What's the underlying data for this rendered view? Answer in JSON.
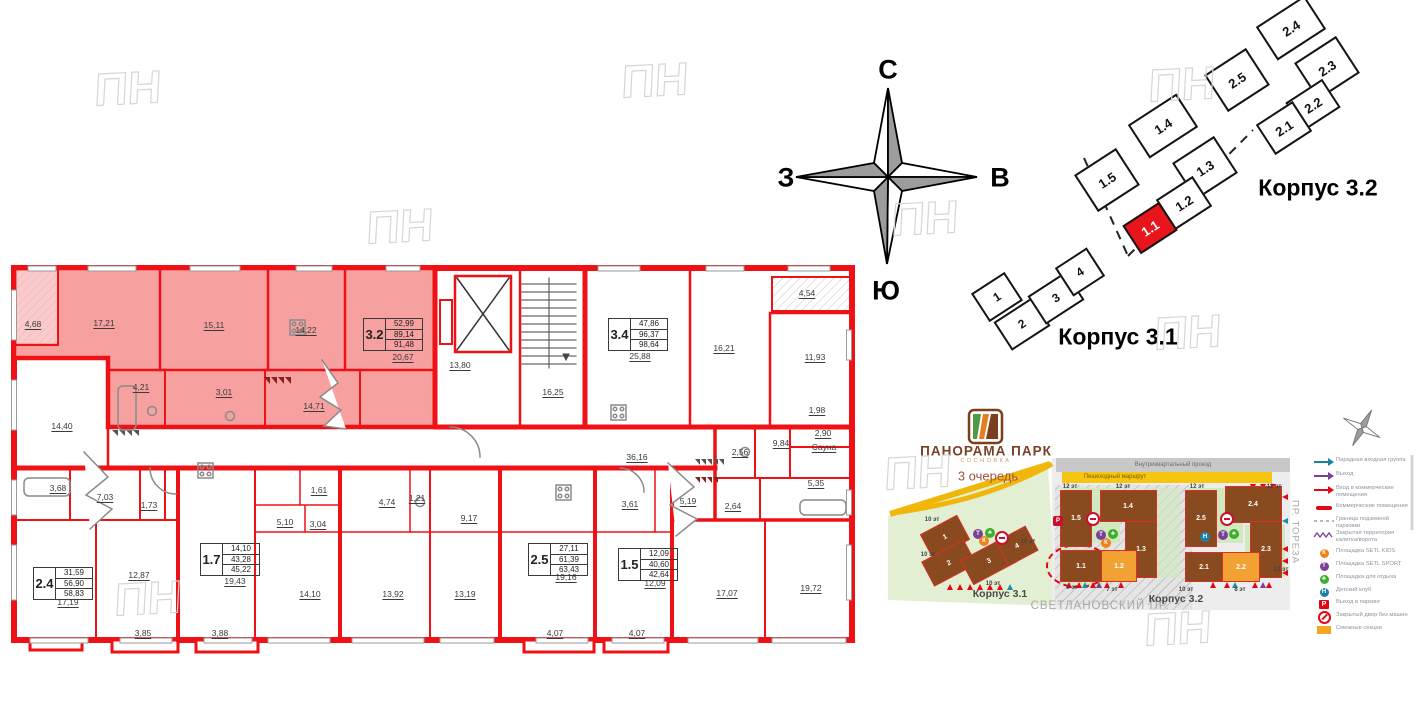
{
  "floor_plan": {
    "wall_color": "#ee1116",
    "highlight_color": "#f7a0a0",
    "room_labels": [
      {
        "t": "4,68",
        "x": 33,
        "y": 324
      },
      {
        "t": "17,21",
        "x": 104,
        "y": 323
      },
      {
        "t": "15,11",
        "x": 214,
        "y": 325
      },
      {
        "t": "14,22",
        "x": 306,
        "y": 330
      },
      {
        "t": "20,67",
        "x": 403,
        "y": 357
      },
      {
        "t": "4,21",
        "x": 141,
        "y": 387
      },
      {
        "t": "3,01",
        "x": 224,
        "y": 392
      },
      {
        "t": "14,71",
        "x": 314,
        "y": 406
      },
      {
        "t": "14,40",
        "x": 62,
        "y": 426
      },
      {
        "t": "13,80",
        "x": 460,
        "y": 365
      },
      {
        "t": "16,25",
        "x": 553,
        "y": 392
      },
      {
        "t": "25,88",
        "x": 640,
        "y": 356
      },
      {
        "t": "16,21",
        "x": 724,
        "y": 348
      },
      {
        "t": "11,93",
        "x": 815,
        "y": 357
      },
      {
        "t": "4,54",
        "x": 807,
        "y": 293
      },
      {
        "t": "1,98",
        "x": 817,
        "y": 410
      },
      {
        "t": "2,90",
        "x": 823,
        "y": 433
      },
      {
        "t": "Сауна",
        "x": 824,
        "y": 447
      },
      {
        "t": "9,84",
        "x": 781,
        "y": 443
      },
      {
        "t": "2,56",
        "x": 740,
        "y": 452
      },
      {
        "t": "36,16",
        "x": 637,
        "y": 457
      },
      {
        "t": "3,68",
        "x": 58,
        "y": 488
      },
      {
        "t": "7,03",
        "x": 105,
        "y": 497
      },
      {
        "t": "1,73",
        "x": 149,
        "y": 505
      },
      {
        "t": "17,19",
        "x": 68,
        "y": 602
      },
      {
        "t": "12,87",
        "x": 139,
        "y": 575
      },
      {
        "t": "3,85",
        "x": 143,
        "y": 633
      },
      {
        "t": "3,88",
        "x": 220,
        "y": 633
      },
      {
        "t": "19,43",
        "x": 235,
        "y": 581
      },
      {
        "t": "14,10",
        "x": 310,
        "y": 594
      },
      {
        "t": "5,10",
        "x": 285,
        "y": 522
      },
      {
        "t": "3,04",
        "x": 318,
        "y": 524
      },
      {
        "t": "1,61",
        "x": 319,
        "y": 490
      },
      {
        "t": "4,74",
        "x": 387,
        "y": 502
      },
      {
        "t": "1,21",
        "x": 417,
        "y": 498
      },
      {
        "t": "9,17",
        "x": 469,
        "y": 518
      },
      {
        "t": "13,92",
        "x": 393,
        "y": 594
      },
      {
        "t": "13,19",
        "x": 465,
        "y": 594
      },
      {
        "t": "19,16",
        "x": 566,
        "y": 577
      },
      {
        "t": "4,07",
        "x": 555,
        "y": 633
      },
      {
        "t": "3,61",
        "x": 630,
        "y": 504
      },
      {
        "t": "12,09",
        "x": 655,
        "y": 583
      },
      {
        "t": "4,07",
        "x": 637,
        "y": 633
      },
      {
        "t": "5,19",
        "x": 688,
        "y": 501
      },
      {
        "t": "2,64",
        "x": 733,
        "y": 506
      },
      {
        "t": "5,35",
        "x": 816,
        "y": 483
      },
      {
        "t": "17,07",
        "x": 727,
        "y": 593
      },
      {
        "t": "19,72",
        "x": 811,
        "y": 588
      }
    ],
    "apartments": [
      {
        "id": "3.2",
        "values": [
          "52,99",
          "89,14",
          "91,48"
        ],
        "x": 363,
        "y": 318,
        "hl": true
      },
      {
        "id": "3.4",
        "values": [
          "47,86",
          "96,37",
          "98,64"
        ],
        "x": 608,
        "y": 318,
        "hl": false
      },
      {
        "id": "2.4",
        "values": [
          "31,59",
          "56,90",
          "58,83"
        ],
        "x": 33,
        "y": 567,
        "hl": false
      },
      {
        "id": "1.7",
        "values": [
          "14,10",
          "43,28",
          "45,22"
        ],
        "x": 200,
        "y": 543,
        "hl": false
      },
      {
        "id": "2.5",
        "values": [
          "27,11",
          "61,39",
          "63,43"
        ],
        "x": 528,
        "y": 543,
        "hl": false
      },
      {
        "id": "1.5",
        "values": [
          "12,09",
          "40,60",
          "42,64"
        ],
        "x": 618,
        "y": 548,
        "hl": false
      }
    ]
  },
  "compass": {
    "n": "С",
    "s": "Ю",
    "w": "З",
    "e": "В"
  },
  "building_scheme": {
    "korpus_32_label": "Корпус 3.2",
    "korpus_31_label": "Корпус 3.1",
    "selected_unit": "1.1",
    "units": [
      {
        "id": "1.5",
        "x": 1107,
        "y": 180,
        "w": 46,
        "h": 40,
        "sel": false
      },
      {
        "id": "1.4",
        "x": 1163,
        "y": 126,
        "w": 54,
        "h": 36,
        "sel": false
      },
      {
        "id": "1.3",
        "x": 1205,
        "y": 168,
        "w": 46,
        "h": 40,
        "sel": false
      },
      {
        "id": "1.2",
        "x": 1184,
        "y": 203,
        "w": 40,
        "h": 32,
        "sel": false
      },
      {
        "id": "1.1",
        "x": 1150,
        "y": 228,
        "w": 40,
        "h": 30,
        "sel": true
      },
      {
        "id": "2.5",
        "x": 1237,
        "y": 80,
        "w": 46,
        "h": 40,
        "sel": false
      },
      {
        "id": "2.4",
        "x": 1291,
        "y": 28,
        "w": 54,
        "h": 36,
        "sel": false
      },
      {
        "id": "2.3",
        "x": 1327,
        "y": 68,
        "w": 46,
        "h": 40,
        "sel": false
      },
      {
        "id": "2.2",
        "x": 1313,
        "y": 105,
        "w": 40,
        "h": 30,
        "sel": false
      },
      {
        "id": "2.1",
        "x": 1284,
        "y": 128,
        "w": 40,
        "h": 32,
        "sel": false
      }
    ],
    "sections": [
      {
        "id": "1",
        "x": 997,
        "y": 297,
        "w": 36,
        "h": 30
      },
      {
        "id": "2",
        "x": 1022,
        "y": 324,
        "w": 42,
        "h": 30
      },
      {
        "id": "3",
        "x": 1056,
        "y": 298,
        "w": 42,
        "h": 30
      },
      {
        "id": "4",
        "x": 1080,
        "y": 272,
        "w": 34,
        "h": 30
      }
    ]
  },
  "site_plan": {
    "logo": {
      "title": "ПАНОРАМА ПАРК",
      "subtitle": "СОСНОВКА",
      "phase": "3 очередь"
    },
    "roads": {
      "driveway": "Внутриквартальный проезд",
      "pedestrian": "Пешеходный маршрут"
    },
    "streets": {
      "svetlanovsky": "СВЕТЛАНОВСКИЙ ПР.",
      "toreza": "ПР. ТОРЕЗА"
    },
    "korpus_31_label": "Корпус 3.1",
    "korpus_32_label": "Корпус 3.2",
    "buildings": [
      {
        "id": "1.5",
        "x": 1075,
        "y": 517,
        "w": 30,
        "h": 55,
        "bg": "brown",
        "rot": 0
      },
      {
        "id": "1.4",
        "x": 1127,
        "y": 505,
        "w": 55,
        "h": 30,
        "bg": "brown",
        "rot": 0
      },
      {
        "id": "1.3",
        "x": 1140,
        "y": 548,
        "w": 30,
        "h": 55,
        "bg": "brown",
        "rot": 0
      },
      {
        "id": "1.1",
        "x": 1080,
        "y": 565,
        "w": 40,
        "h": 30,
        "bg": "brown",
        "rot": 0
      },
      {
        "id": "1.2",
        "x": 1118,
        "y": 565,
        "w": 34,
        "h": 30,
        "bg": "orange",
        "rot": 0
      },
      {
        "id": "2.5",
        "x": 1200,
        "y": 517,
        "w": 30,
        "h": 55,
        "bg": "brown",
        "rot": 0
      },
      {
        "id": "2.4",
        "x": 1252,
        "y": 503,
        "w": 55,
        "h": 35,
        "bg": "brown",
        "rot": 0
      },
      {
        "id": "2.3",
        "x": 1265,
        "y": 548,
        "w": 30,
        "h": 55,
        "bg": "brown",
        "rot": 0
      },
      {
        "id": "2.1",
        "x": 1203,
        "y": 566,
        "w": 37,
        "h": 28,
        "bg": "brown",
        "rot": 0
      },
      {
        "id": "2.2",
        "x": 1240,
        "y": 566,
        "w": 36,
        "h": 28,
        "bg": "orange",
        "rot": 0
      },
      {
        "id": "1",
        "x": 944,
        "y": 536,
        "w": 40,
        "h": 26,
        "bg": "brown",
        "rot": -28
      },
      {
        "id": "2",
        "x": 948,
        "y": 562,
        "w": 46,
        "h": 26,
        "bg": "brown",
        "rot": -28
      },
      {
        "id": "3",
        "x": 988,
        "y": 560,
        "w": 48,
        "h": 26,
        "bg": "brown",
        "rot": -28
      },
      {
        "id": "4",
        "x": 1016,
        "y": 545,
        "w": 32,
        "h": 26,
        "bg": "brown",
        "rot": -28
      }
    ],
    "building_colors": {
      "brown": "#8a4a1f",
      "orange": "#f2a233"
    },
    "floor_labels": [
      {
        "t": "12 эт",
        "x": 1070,
        "y": 487
      },
      {
        "t": "12 эт",
        "x": 1123,
        "y": 487
      },
      {
        "t": "12 эт",
        "x": 1197,
        "y": 487
      },
      {
        "t": "12 эт",
        "x": 1274,
        "y": 487
      },
      {
        "t": "9 эт",
        "x": 1072,
        "y": 588
      },
      {
        "t": "7 эт",
        "x": 1112,
        "y": 590
      },
      {
        "t": "10 эт",
        "x": 1186,
        "y": 590
      },
      {
        "t": "8 эт",
        "x": 1240,
        "y": 590
      },
      {
        "t": "12 эт",
        "x": 1281,
        "y": 570
      },
      {
        "t": "10 эт",
        "x": 932,
        "y": 520
      },
      {
        "t": "10 эт",
        "x": 928,
        "y": 555
      },
      {
        "t": "10 эт",
        "x": 993,
        "y": 584
      },
      {
        "t": "10 эт",
        "x": 1028,
        "y": 542
      }
    ],
    "amenity_icons": [
      {
        "x": 1093,
        "y": 519,
        "c": "#c8102e",
        "g": "nocar"
      },
      {
        "x": 1101,
        "y": 535,
        "c": "#7c3f98",
        "g": "Т"
      },
      {
        "x": 1113,
        "y": 534,
        "c": "#3daf2c",
        "g": "♣"
      },
      {
        "x": 1106,
        "y": 543,
        "c": "#f0821e",
        "g": "К"
      },
      {
        "x": 1058,
        "y": 521,
        "c": "#c8102e",
        "g": "P"
      },
      {
        "x": 1227,
        "y": 519,
        "c": "#c8102e",
        "g": "nocar"
      },
      {
        "x": 1205,
        "y": 537,
        "c": "#1b7fa8",
        "g": "Н"
      },
      {
        "x": 1223,
        "y": 535,
        "c": "#7c3f98",
        "g": "Т"
      },
      {
        "x": 1234,
        "y": 534,
        "c": "#3daf2c",
        "g": "♣"
      },
      {
        "x": 978,
        "y": 534,
        "c": "#7c3f98",
        "g": "Т"
      },
      {
        "x": 990,
        "y": 533,
        "c": "#3daf2c",
        "g": "♣"
      },
      {
        "x": 984,
        "y": 541,
        "c": "#f0821e",
        "g": "К"
      },
      {
        "x": 1002,
        "y": 538,
        "c": "#c8102e",
        "g": "nocar"
      }
    ],
    "legend": [
      {
        "icon": "arrow",
        "color": "#1b7fa8",
        "label": "Парадная входная группа",
        "y": 457
      },
      {
        "icon": "arrow",
        "color": "#7c3f98",
        "label": "Выход",
        "y": 471
      },
      {
        "icon": "arrow",
        "color": "#e30613",
        "label": "Вход в коммерческие помещения",
        "y": 485
      },
      {
        "icon": "bar",
        "color": "#e30613",
        "label": "Коммерческие помещения",
        "y": 503
      },
      {
        "icon": "dash",
        "color": "#9aa0a8",
        "label": "Граница подземной парковки",
        "y": 516
      },
      {
        "icon": "zigzag",
        "color": "#7c3f98",
        "label": "Закрытая территория калитка/ворота",
        "y": 530
      },
      {
        "icon": "circle",
        "color": "#f0821e",
        "glyph": "К",
        "label": "Площадка SETL KIDS",
        "y": 548
      },
      {
        "icon": "circle",
        "color": "#7c3f98",
        "glyph": "Т",
        "label": "Площадка SETL SPORT",
        "y": 561
      },
      {
        "icon": "circle",
        "color": "#3daf2c",
        "glyph": "♣",
        "label": "Площадка для отдыха",
        "y": 574
      },
      {
        "icon": "circle",
        "color": "#1b7fa8",
        "glyph": "Н",
        "label": "Детский клуб",
        "y": 587
      },
      {
        "icon": "parking",
        "color": "#e30613",
        "glyph": "P",
        "label": "Выход в паркинг",
        "y": 599
      },
      {
        "icon": "nocar",
        "color": "#e30613",
        "label": "Закрытый двор без машин",
        "y": 612
      },
      {
        "icon": "swatch",
        "color": "#f5a623",
        "label": "Смежные секции",
        "y": 625
      }
    ]
  },
  "watermark": "ПН",
  "watermark_positions": [
    {
      "x": 128,
      "y": 88
    },
    {
      "x": 655,
      "y": 80
    },
    {
      "x": 400,
      "y": 226
    },
    {
      "x": 925,
      "y": 218
    },
    {
      "x": 1182,
      "y": 84
    },
    {
      "x": 918,
      "y": 472
    },
    {
      "x": 1188,
      "y": 332
    },
    {
      "x": 148,
      "y": 598
    },
    {
      "x": 1178,
      "y": 628
    }
  ]
}
